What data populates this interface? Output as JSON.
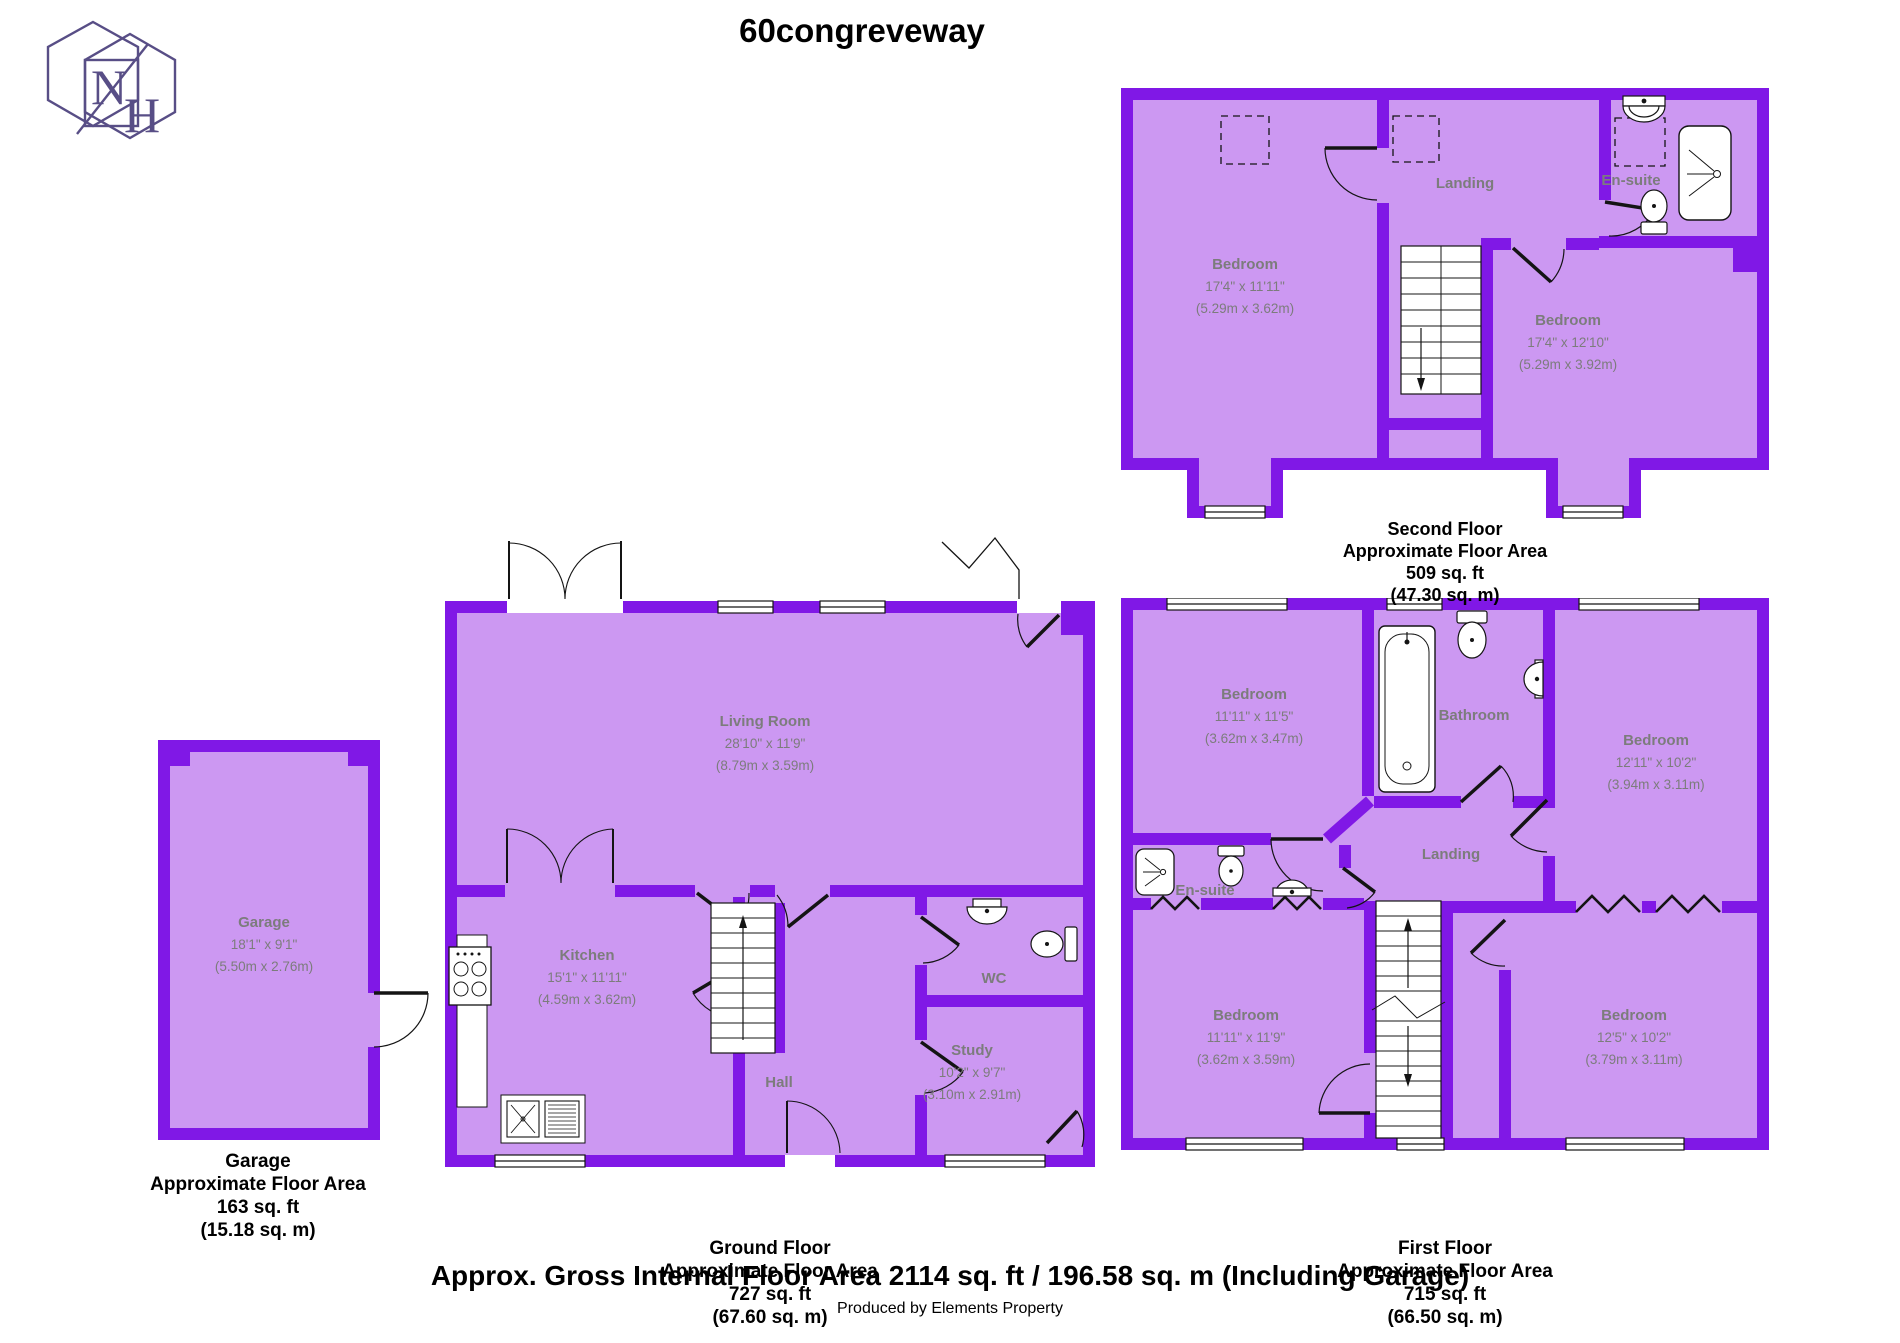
{
  "title": "60congreveway",
  "logo": {
    "letter_n": "N",
    "letter_h": "H"
  },
  "colors": {
    "wall": "#8018e6",
    "room_fill": "#cc98f2",
    "label_gray": "#7c7c7c",
    "logo_purple": "#584e86",
    "line_black": "#141414"
  },
  "second_floor": {
    "bedroom_left": {
      "name": "Bedroom",
      "imperial": "17'4\" x 11'11\"",
      "metric": "(5.29m x 3.62m)"
    },
    "landing": {
      "name": "Landing"
    },
    "en_suite": {
      "name": "En-suite"
    },
    "bedroom_right": {
      "name": "Bedroom",
      "imperial": "17'4\" x 12'10\"",
      "metric": "(5.29m x 3.92m)"
    },
    "caption": {
      "line1": "Second Floor",
      "line2": "Approximate Floor Area",
      "line3": "509 sq. ft",
      "line4": "(47.30 sq. m)"
    }
  },
  "ground_floor": {
    "living_room": {
      "name": "Living Room",
      "imperial": "28'10\" x 11'9\"",
      "metric": "(8.79m x 3.59m)"
    },
    "kitchen": {
      "name": "Kitchen",
      "imperial": "15'1\" x 11'11\"",
      "metric": "(4.59m x 3.62m)"
    },
    "hall": {
      "name": "Hall"
    },
    "wc": {
      "name": "WC"
    },
    "study": {
      "name": "Study",
      "imperial": "10'2\" x 9'7\"",
      "metric": "(3.10m x 2.91m)"
    },
    "caption": {
      "line1": "Ground Floor",
      "line2": "Approximate Floor Area",
      "line3": "727 sq. ft",
      "line4": "(67.60 sq. m)"
    }
  },
  "first_floor": {
    "bedroom_front_left": {
      "name": "Bedroom",
      "imperial": "11'11\" x 11'5\"",
      "metric": "(3.62m x 3.47m)"
    },
    "bathroom": {
      "name": "Bathroom"
    },
    "bedroom_front_right": {
      "name": "Bedroom",
      "imperial": "12'11\" x 10'2\"",
      "metric": "(3.94m x 3.11m)"
    },
    "en_suite": {
      "name": "En-suite"
    },
    "landing": {
      "name": "Landing"
    },
    "bedroom_back_left": {
      "name": "Bedroom",
      "imperial": "11'11\" x 11'9\"",
      "metric": "(3.62m x 3.59m)"
    },
    "bedroom_back_right": {
      "name": "Bedroom",
      "imperial": "12'5\" x 10'2\"",
      "metric": "(3.79m x 3.11m)"
    },
    "caption": {
      "line1": "First Floor",
      "line2": "Approximate Floor Area",
      "line3": "715 sq. ft",
      "line4": "(66.50 sq. m)"
    }
  },
  "garage": {
    "room": {
      "name": "Garage",
      "imperial": "18'1\" x 9'1\"",
      "metric": "(5.50m x 2.76m)"
    },
    "caption": {
      "line1": "Garage",
      "line2": "Approximate Floor Area",
      "line3": "163 sq. ft",
      "line4": "(15.18 sq. m)"
    }
  },
  "footer": {
    "summary": "Approx. Gross Internal Floor Area 2114 sq. ft / 196.58 sq. m (Including Garage)",
    "credit": "Produced by Elements Property"
  }
}
